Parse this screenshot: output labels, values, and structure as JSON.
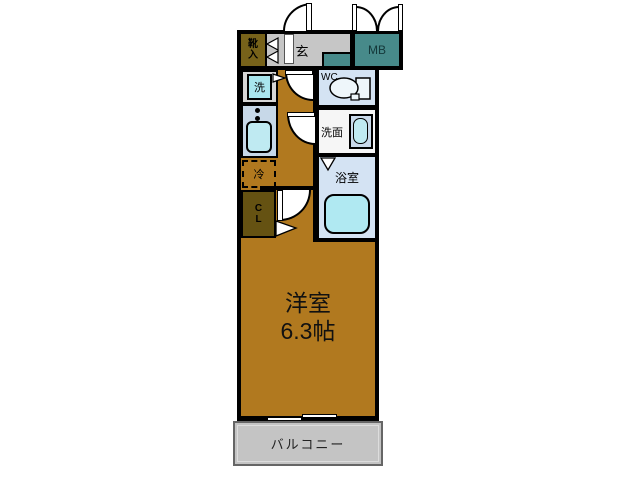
{
  "plan": {
    "entrance": {
      "label": "玄"
    },
    "shoe_storage": {
      "char1": "靴",
      "char2": "入"
    },
    "meter_box": {
      "label": "MB"
    },
    "washer": {
      "label": "洗"
    },
    "toilet": {
      "label": "WC"
    },
    "washroom": {
      "label": "洗面"
    },
    "bathroom": {
      "label": "浴室"
    },
    "refrigerator": {
      "label": "冷"
    },
    "closet": {
      "char1": "C",
      "char2": "L"
    },
    "main_room": {
      "name": "洋室",
      "size": "6.3帖"
    },
    "balcony": {
      "label": "バルコニー"
    }
  },
  "colors": {
    "wall": "#000000",
    "room_brown": "#b1791f",
    "entrance_gray": "#c6c6c6",
    "meter_box_teal": "#478a8a",
    "shoe_olive": "#77621a",
    "closet_olive": "#655212",
    "fixture_aqua": "#b0e9f2",
    "washer_aqua": "#a9e6ee",
    "wet_room_blue": "#d4e3f3",
    "kitchen_blue": "#c7d8e8",
    "washroom_white": "#f6f6f6",
    "balcony_gray": "#c4c4c4"
  }
}
